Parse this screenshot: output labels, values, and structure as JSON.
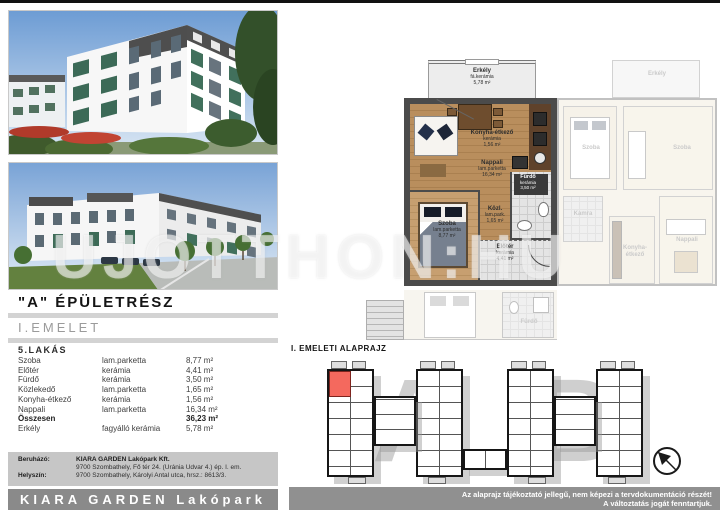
{
  "header": {
    "building_section": "\"A\" ÉPÜLETRÉSZ",
    "floor": "I.EMELET"
  },
  "unit_table": {
    "title": "5.LAKÁS",
    "rows": [
      {
        "room": "Szoba",
        "material": "lam.parketta",
        "area": "8,77 m²"
      },
      {
        "room": "Előtér",
        "material": "kerámia",
        "area": "4,41 m²"
      },
      {
        "room": "Fürdő",
        "material": "kerámia",
        "area": "3,50 m²"
      },
      {
        "room": "Közlekedő",
        "material": "lam.parketta",
        "area": "1,65 m²"
      },
      {
        "room": "Konyha-étkező",
        "material": "kerámia",
        "area": "1,56 m²"
      },
      {
        "room": "Nappali",
        "material": "lam.parketta",
        "area": "16,34 m²"
      }
    ],
    "total_label": "Összesen",
    "total_area": "36,23 m²",
    "balcony_row": {
      "room": "Erkély",
      "material": "fagyálló kerámia",
      "area": "5,78 m²"
    }
  },
  "developer": {
    "label": "Beruházó:",
    "name": "KIARA GARDEN Lakópark Kft.",
    "address": "9700 Szombathely, Fő tér 24. (Uránia Udvar 4.) ép. I. em.",
    "site_label": "Helyszín:",
    "site": "9700 Szombathely, Károlyi Antal utca, hrsz.: 8613/3."
  },
  "brand": {
    "logo_text": "KIARA GARDEN Lakópark"
  },
  "floorplan": {
    "balcony": {
      "name": "Erkély",
      "material": "fá.kerámia",
      "area": "5,78 m²"
    },
    "konyha": {
      "name": "Konyha-étkező",
      "material": "kerámia",
      "area": "1,56 m²"
    },
    "nappali": {
      "name": "Nappali",
      "material": "lam.parketta",
      "area": "16,34 m²"
    },
    "szoba": {
      "name": "Szoba",
      "material": "lam.parketta",
      "area": "8,77 m²"
    },
    "furdo": {
      "name": "Fürdő",
      "material": "kerámia",
      "area": "3,50 m²"
    },
    "kozl": {
      "name": "Közl.",
      "material": "lam.park.",
      "area": "1,65 m²"
    },
    "eloter": {
      "name": "Előtér",
      "material": "kerámia",
      "area": "4,41 m²"
    },
    "neighbor": {
      "szoba": "Szoba",
      "szoba2": "Szoba",
      "kamra": "Kamra",
      "konyha": "Konyha-étkező",
      "nappali": "Nappali",
      "erkely": "Erkély",
      "furdo": "Fürdő"
    }
  },
  "overview": {
    "title": "I. EMELETI ALAPRAJZ",
    "section_a": "A",
    "section_b": "B"
  },
  "watermark": {
    "part1": "UJOTTHON",
    "sep": ":",
    "part2": "HU"
  },
  "disclaimer": {
    "line1": "Az alaprajz tájékoztató jellegű, nem képezi a tervdokumentáció részét!",
    "line2": "A változtatás jogát fenntartjuk."
  },
  "colors": {
    "highlight_unit": "#f4695e",
    "bar_gray": "#8e8e8e",
    "wood": "#b98e5d",
    "wall": "#4b4b4b"
  }
}
